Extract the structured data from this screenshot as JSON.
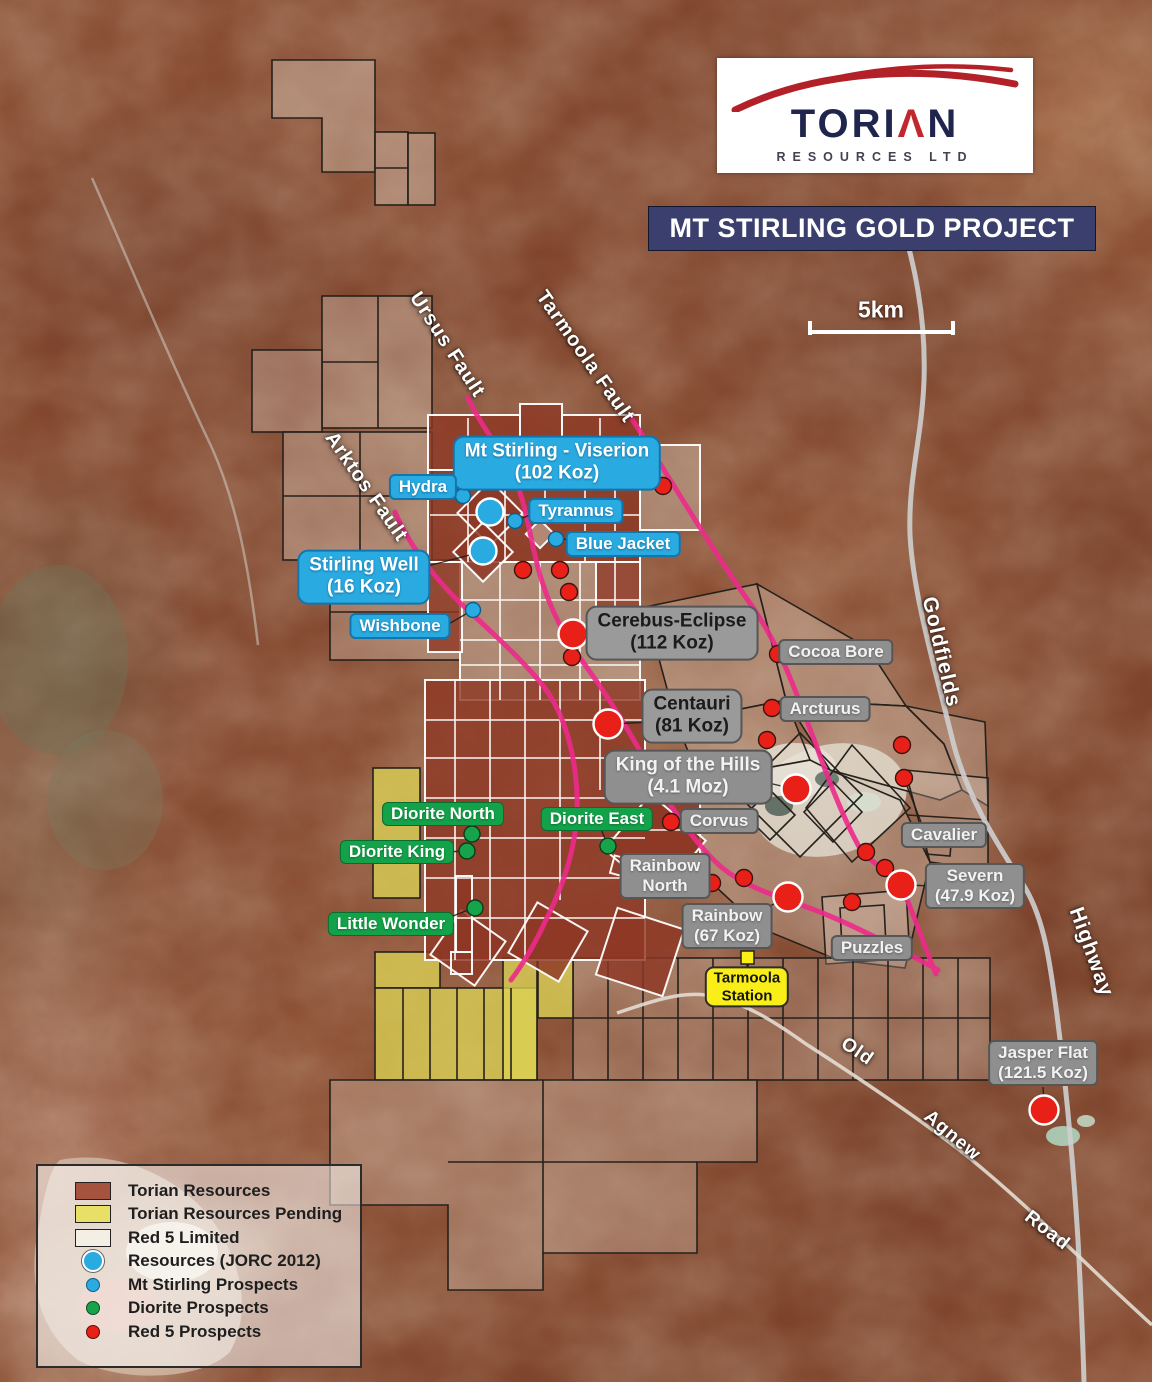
{
  "logo": {
    "brand_parts": {
      "left": "TORI",
      "accent": "Λ",
      "right": "N"
    },
    "brand": "TORIAN",
    "brand_sub": "RESOURCES LTD"
  },
  "title_banner": "MT STIRLING GOLD PROJECT",
  "scale_bar_label": "5km",
  "fault_labels": {
    "ursus": "Ursus Fault",
    "tarmoola": "Tarmoola Fault",
    "arktos": "Arktos Fault"
  },
  "road_labels": {
    "goldfields": "Goldfields",
    "highway": "Highway",
    "old": "Old",
    "agnew": "Agnew",
    "road": "Road"
  },
  "prospect_labels": {
    "mt_stirling_viserion": {
      "line1": "Mt Stirling - Viserion",
      "line2": "(102 Koz)"
    },
    "hydra": {
      "text": "Hydra"
    },
    "tyrannus": {
      "text": "Tyrannus"
    },
    "blue_jacket": {
      "text": "Blue Jacket"
    },
    "stirling_well": {
      "line1": "Stirling Well",
      "line2": "(16 Koz)"
    },
    "wishbone": {
      "text": "Wishbone"
    },
    "cerebus_eclipse": {
      "line1": "Cerebus-Eclipse",
      "line2": "(112 Koz)"
    },
    "cocoa_bore": {
      "text": "Cocoa Bore"
    },
    "centauri": {
      "line1": "Centauri",
      "line2": "(81 Koz)"
    },
    "arcturus": {
      "text": "Arcturus"
    },
    "king_of_the_hills": {
      "line1": "King of the Hills",
      "line2": "(4.1 Moz)"
    },
    "corvus": {
      "text": "Corvus"
    },
    "cavalier": {
      "text": "Cavalier"
    },
    "severn": {
      "line1": "Severn",
      "line2": "(47.9 Koz)"
    },
    "diorite_north": {
      "text": "Diorite North"
    },
    "diorite_king": {
      "text": "Diorite King"
    },
    "diorite_east": {
      "text": "Diorite East"
    },
    "little_wonder": {
      "text": "Little Wonder"
    },
    "rainbow_north": {
      "line1": "Rainbow",
      "line2": "North"
    },
    "rainbow": {
      "line1": "Rainbow",
      "line2": "(67 Koz)"
    },
    "puzzles": {
      "text": "Puzzles"
    },
    "tarmoola_station": {
      "line1": "Tarmoola",
      "line2": "Station"
    },
    "jasper_flat": {
      "line1": "Jasper Flat",
      "line2": "(121.5 Koz)"
    }
  },
  "legend": {
    "items": [
      {
        "label": "Torian Resources",
        "swatch": "torian-tenement",
        "color": "#A5523F"
      },
      {
        "label": "Torian Resources Pending",
        "swatch": "pending-tenement",
        "color": "#E7DF66"
      },
      {
        "label": "Red 5 Limited",
        "swatch": "red5-tenement",
        "color": "#F4EFE5"
      },
      {
        "label": "Resources (JORC 2012)",
        "swatch": "resource-circle-large-blue",
        "color": "#29ABE2"
      },
      {
        "label": "Mt Stirling Prospects",
        "swatch": "prospect-circle-blue",
        "color": "#29ABE2"
      },
      {
        "label": "Diorite Prospects",
        "swatch": "prospect-circle-green",
        "color": "#16A34A"
      },
      {
        "label": "Red 5 Prospects",
        "swatch": "prospect-circle-red",
        "color": "#E92017"
      }
    ]
  },
  "colors": {
    "fault_line": "#EE2A8B",
    "banner_bg": "#3B3F6D",
    "blue_label_bg": "#29ABE2",
    "gray_label_bg": "#8F8F8F",
    "green_label_bg": "#13A24A",
    "station_label_bg": "#F9EE17",
    "torian_fill": "#8D3724",
    "pending_fill": "#DDD254",
    "logo_red": "#B32128",
    "logo_navy": "#1F254C"
  }
}
